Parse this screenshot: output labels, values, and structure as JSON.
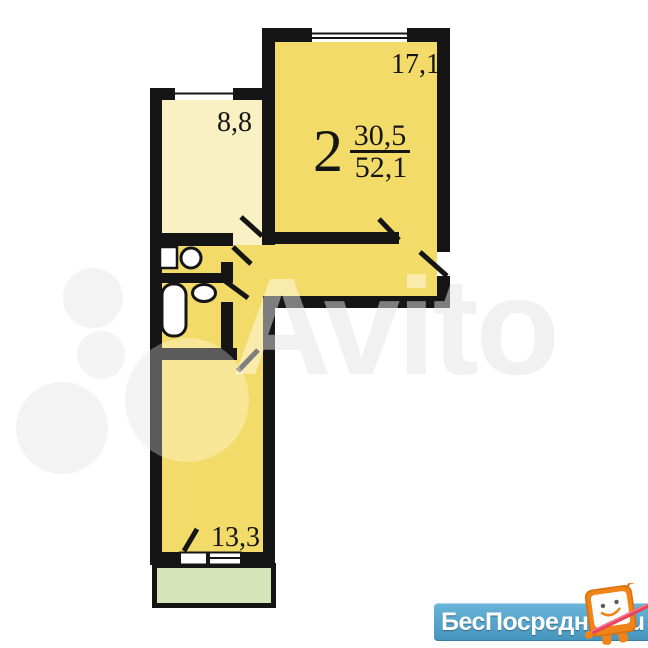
{
  "plan": {
    "apartment": {
      "rooms_count": "2",
      "living_area": "30,5",
      "total_area": "52,1"
    },
    "rooms": [
      {
        "id": "living-room",
        "area_label": "17,1"
      },
      {
        "id": "kitchen",
        "area_label": "8,8"
      },
      {
        "id": "bedroom",
        "area_label": "13,3"
      }
    ],
    "fixtures": [
      "toilet-tank",
      "toilet-bowl",
      "bathtub",
      "sink"
    ],
    "features": [
      "balcony",
      "entrance-door",
      "windows"
    ]
  },
  "watermarks": {
    "center_text": "Avito",
    "banner": {
      "site_name": "БесПосредника",
      "domain_suffix": ".ru"
    }
  },
  "colors": {
    "room_yellow": "#F2DB69",
    "kitchen_light": "#F9F1C4",
    "balcony_green": "#D6E4B9",
    "wall_black": "#151515",
    "banner_blue": "#4D9FC7",
    "mascot_orange": "#F08418",
    "pointer_red": "#E8425C"
  }
}
